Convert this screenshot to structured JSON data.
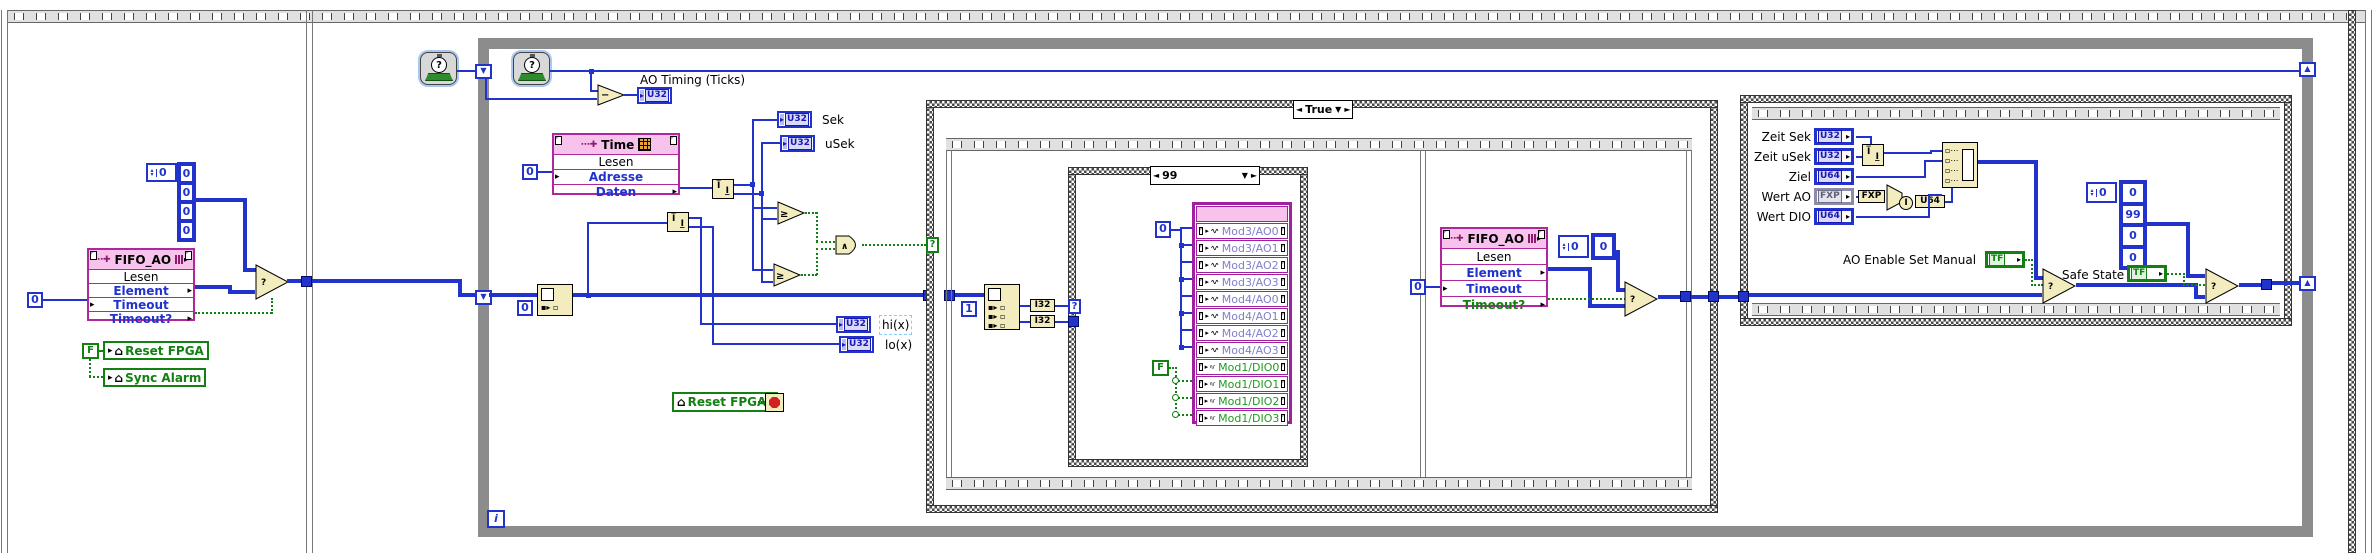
{
  "badges": {
    "u32": "U32",
    "u64": "U64",
    "i32": "I32",
    "fxp": "FXP",
    "tf": "TF",
    "i_cast": "I"
  },
  "left_frame": {
    "array_constant": {
      "index": "0",
      "values": [
        "0",
        "0",
        "0",
        "0"
      ]
    },
    "fifo_node": {
      "title": "FIFO_AO",
      "rows": [
        {
          "label": "Lesen",
          "kind": "name",
          "arrow": ""
        },
        {
          "label": "Element",
          "kind": "io",
          "arrow": "r"
        },
        {
          "label": "Timeout",
          "kind": "io",
          "arrow": "l"
        },
        {
          "label": "Timeout?",
          "kind": "io",
          "arrow": "r"
        }
      ]
    },
    "timeout_constant": "0",
    "false_constant": "F",
    "reset_fpga_local": "Reset FPGA",
    "sync_alarm_local": "Sync Alarm"
  },
  "while_loop": {
    "iteration_terminal": "i",
    "ao_timing_label": "AO Timing (Ticks)",
    "clock_glyph": "?",
    "minus_glyph": "−",
    "gte_glyph": "≥",
    "and_glyph": "∧",
    "sek_label": "Sek",
    "usek_label": "uSek",
    "hix_label": "hi(x)",
    "lox_label": "lo(x)",
    "time_node": {
      "title": "Time",
      "rows": [
        {
          "label": "Lesen",
          "kind": "name",
          "arrow": ""
        },
        {
          "label": "Adresse",
          "kind": "io",
          "arrow": "l"
        },
        {
          "label": "Daten",
          "kind": "io",
          "arrow": "r"
        }
      ],
      "address_constant": "0"
    },
    "index_constant": "0",
    "reset_fpga_local": "Reset FPGA"
  },
  "true_case": {
    "label": "True",
    "selector": "?",
    "one_constant": "1",
    "inner_case": {
      "label": "99",
      "selector": "?",
      "zero_constant": "0",
      "false_constant": "F",
      "io_rows": [
        {
          "label": "Mod3/AO0",
          "type": "ao"
        },
        {
          "label": "Mod3/AO1",
          "type": "ao"
        },
        {
          "label": "Mod3/AO2",
          "type": "ao"
        },
        {
          "label": "Mod3/AO3",
          "type": "ao"
        },
        {
          "label": "Mod4/AO0",
          "type": "ao"
        },
        {
          "label": "Mod4/AO1",
          "type": "ao"
        },
        {
          "label": "Mod4/AO2",
          "type": "ao"
        },
        {
          "label": "Mod4/AO3",
          "type": "ao"
        },
        {
          "label": "Mod1/DIO0",
          "type": "dio"
        },
        {
          "label": "Mod1/DIO1",
          "type": "dio"
        },
        {
          "label": "Mod1/DIO2",
          "type": "dio"
        },
        {
          "label": "Mod1/DIO3",
          "type": "dio"
        }
      ]
    },
    "fifo_node": {
      "title": "FIFO_AO",
      "rows": [
        {
          "label": "Lesen",
          "kind": "name",
          "arrow": ""
        },
        {
          "label": "Element",
          "kind": "io",
          "arrow": "r"
        },
        {
          "label": "Timeout",
          "kind": "io",
          "arrow": "l"
        },
        {
          "label": "Timeout?",
          "kind": "bool",
          "arrow": "r"
        }
      ]
    },
    "timeout_constant": "0",
    "array_constant": {
      "index": "0",
      "values": [
        "0"
      ]
    }
  },
  "right_case": {
    "controls": [
      {
        "label": "Zeit Sek",
        "type": "U32"
      },
      {
        "label": "Zeit uSek",
        "type": "U32"
      },
      {
        "label": "Ziel",
        "type": "U64"
      },
      {
        "label": "Wert AO",
        "type": "FXP"
      },
      {
        "label": "Wert DIO",
        "type": "U64"
      }
    ],
    "ao_enable_label": "AO Enable Set Manual",
    "safe_state_label": "Safe State",
    "array_constant": {
      "index": "0",
      "values": [
        "0",
        "99",
        "0",
        "0"
      ]
    }
  },
  "colors": {
    "wire_blue": "#2233CC",
    "bool_green": "#128012",
    "node_pink": "#B0279C",
    "io_purple": "#A020A0",
    "function_beige": "#F2ECBE",
    "loop_gray": "#8C8C8C"
  }
}
